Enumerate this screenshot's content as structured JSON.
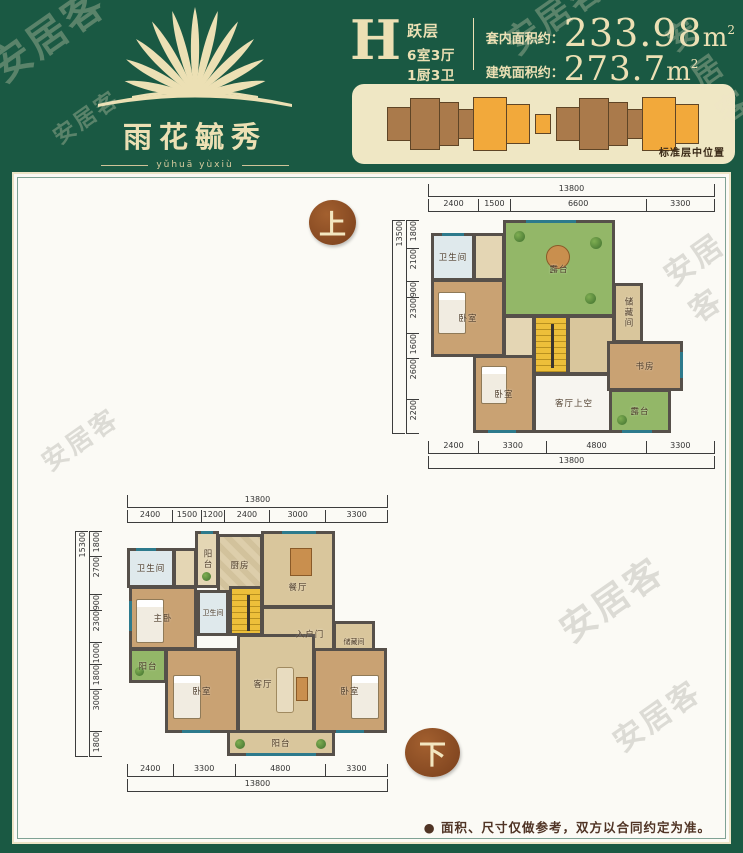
{
  "page": {
    "watermark": "安居客",
    "disclaimer": "● 面积、尺寸仅做参考，双方以合同约定为准。"
  },
  "header": {
    "logo": {
      "name": "雨花毓秀",
      "pinyin": "yǔhuā yùxiù"
    },
    "unit": {
      "letter": "H",
      "type_label": "跃层",
      "layout_label": "6室3厅1厨3卫3阳台",
      "inner_area_label": "套内面积约：",
      "inner_area_value": "233.98",
      "build_area_label": "建筑面积约：",
      "build_area_value": "273.7",
      "area_unit": "m",
      "area_unit_sup": "2"
    },
    "strip_caption": "标准层中位置"
  },
  "plans": {
    "upper": {
      "marker": "上",
      "dims_top": {
        "total": "13800",
        "segments": [
          "2400",
          "1500",
          "6600",
          "3300"
        ]
      },
      "dims_left": {
        "total": "13500",
        "segments": [
          "1800",
          "2100",
          "900",
          "2300",
          "1600",
          "2600",
          "2200"
        ]
      },
      "dims_bottom": {
        "total": "13800",
        "segments": [
          "2400",
          "3300",
          "4800",
          "3300"
        ]
      },
      "rooms": {
        "bath": "卫生间",
        "bedroom_left": "卧室",
        "terrace": "露台",
        "storage": "储藏间",
        "study": "书房",
        "bedroom_bottom": "卧室",
        "living_void": "客厅上空",
        "terrace_small": "露台"
      }
    },
    "lower": {
      "marker": "下",
      "dims_top": {
        "total": "13800",
        "segments": [
          "2400",
          "1500",
          "1200",
          "2400",
          "3000",
          "3300"
        ]
      },
      "dims_left": {
        "total": "15300",
        "segments": [
          "1800",
          "2700",
          "900",
          "2300",
          "1000",
          "1800",
          "3000",
          "1800"
        ]
      },
      "dims_bottom": {
        "total": "13800",
        "segments": [
          "2400",
          "3300",
          "4800",
          "3300"
        ]
      },
      "rooms": {
        "bath_top": "卫生间",
        "balcony_top": "阳台",
        "kitchen": "厨房",
        "dining": "餐厅",
        "master": "主卧",
        "bath_mid": "卫生间",
        "entry": "入户门",
        "storage": "储藏间",
        "balcony_left": "阳台",
        "bedroom_left": "卧室",
        "living": "客厅",
        "bedroom_right": "卧室",
        "balcony_bottom": "阳台"
      }
    }
  },
  "colors": {
    "background_green": "#1a5943",
    "cream": "#ece0b4",
    "strip_orange": "#f2a93b",
    "strip_brown": "#aa7a4b",
    "wall": "#56504a",
    "terrace_green": "#93b768",
    "stairs_yellow": "#edbf3a"
  }
}
